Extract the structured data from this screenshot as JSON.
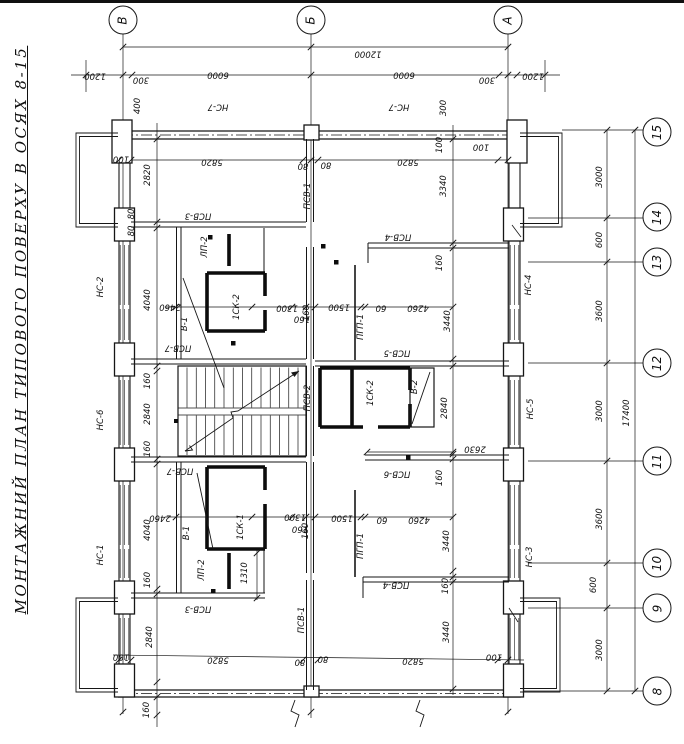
{
  "title": "МОНТАЖНИЙ ПЛАН ТИПОВОГО ПОВЕРХУ В ОСЯХ 8-15",
  "colors": {
    "ink": "#161616",
    "paper": "#ffffff"
  },
  "axes": {
    "top": [
      {
        "t": "В",
        "x": 123,
        "y": 20
      },
      {
        "t": "Б",
        "x": 311,
        "y": 20
      },
      {
        "t": "А",
        "x": 508,
        "y": 20
      }
    ],
    "right": [
      {
        "t": "15",
        "x": 657,
        "y": 132
      },
      {
        "t": "14",
        "x": 657,
        "y": 217
      },
      {
        "t": "13",
        "x": 657,
        "y": 262
      },
      {
        "t": "12",
        "x": 657,
        "y": 363
      },
      {
        "t": "11",
        "x": 657,
        "y": 461
      },
      {
        "t": "10",
        "x": 657,
        "y": 563
      },
      {
        "t": "9",
        "x": 657,
        "y": 608
      },
      {
        "t": "8",
        "x": 657,
        "y": 691
      }
    ]
  },
  "dimensions": [
    {
      "t": "12000",
      "x": 368,
      "y": 53,
      "o": "h"
    },
    {
      "t": "1200",
      "x": 95,
      "y": 75,
      "o": "h"
    },
    {
      "t": "300",
      "x": 141,
      "y": 79,
      "o": "h"
    },
    {
      "t": "6000",
      "x": 218,
      "y": 74,
      "o": "h"
    },
    {
      "t": "6000",
      "x": 404,
      "y": 74,
      "o": "h"
    },
    {
      "t": "300",
      "x": 487,
      "y": 79,
      "o": "h"
    },
    {
      "t": "1200",
      "x": 533,
      "y": 75,
      "o": "h"
    },
    {
      "t": "400",
      "x": 138,
      "y": 106,
      "o": "v"
    },
    {
      "t": "300",
      "x": 444,
      "y": 108,
      "o": "v"
    },
    {
      "t": "100",
      "x": 440,
      "y": 145,
      "o": "v"
    },
    {
      "t": "100",
      "x": 121,
      "y": 158,
      "o": "h"
    },
    {
      "t": "5820",
      "x": 212,
      "y": 161,
      "o": "h"
    },
    {
      "t": "80",
      "x": 303,
      "y": 165,
      "o": "h"
    },
    {
      "t": "80",
      "x": 326,
      "y": 164,
      "o": "h"
    },
    {
      "t": "5820",
      "x": 408,
      "y": 161,
      "o": "h"
    },
    {
      "t": "100",
      "x": 481,
      "y": 146,
      "o": "h"
    },
    {
      "t": "2820",
      "x": 148,
      "y": 175,
      "o": "v"
    },
    {
      "t": "3340",
      "x": 444,
      "y": 186,
      "o": "v"
    },
    {
      "t": "80",
      "x": 132,
      "y": 214,
      "o": "v"
    },
    {
      "t": "80",
      "x": 132,
      "y": 231,
      "o": "v"
    },
    {
      "t": "4040",
      "x": 148,
      "y": 300,
      "o": "v"
    },
    {
      "t": "160",
      "x": 148,
      "y": 381,
      "o": "v"
    },
    {
      "t": "2840",
      "x": 148,
      "y": 414,
      "o": "v"
    },
    {
      "t": "160",
      "x": 148,
      "y": 449,
      "o": "v"
    },
    {
      "t": "4040",
      "x": 148,
      "y": 530,
      "o": "v"
    },
    {
      "t": "160",
      "x": 148,
      "y": 580,
      "o": "v"
    },
    {
      "t": "2840",
      "x": 150,
      "y": 637,
      "o": "v"
    },
    {
      "t": "100",
      "x": 121,
      "y": 656,
      "o": "h"
    },
    {
      "t": "160",
      "x": 147,
      "y": 710,
      "o": "v"
    },
    {
      "t": "160",
      "x": 440,
      "y": 263,
      "o": "v"
    },
    {
      "t": "3440",
      "x": 448,
      "y": 321,
      "o": "v"
    },
    {
      "t": "2840",
      "x": 445,
      "y": 408,
      "o": "v"
    },
    {
      "t": "2630",
      "x": 475,
      "y": 448,
      "o": "h"
    },
    {
      "t": "160",
      "x": 440,
      "y": 478,
      "o": "v"
    },
    {
      "t": "3440",
      "x": 447,
      "y": 541,
      "o": "v"
    },
    {
      "t": "160",
      "x": 446,
      "y": 586,
      "o": "v"
    },
    {
      "t": "3440",
      "x": 447,
      "y": 632,
      "o": "v"
    },
    {
      "t": "2460",
      "x": 170,
      "y": 306,
      "o": "h"
    },
    {
      "t": "1300",
      "x": 287,
      "y": 307,
      "o": "h"
    },
    {
      "t": "160",
      "x": 302,
      "y": 318,
      "o": "h"
    },
    {
      "t": "1500",
      "x": 339,
      "y": 306,
      "o": "h"
    },
    {
      "t": "60",
      "x": 381,
      "y": 307,
      "o": "h"
    },
    {
      "t": "4260",
      "x": 418,
      "y": 307,
      "o": "h"
    },
    {
      "t": "160",
      "x": 307,
      "y": 313,
      "o": "v"
    },
    {
      "t": "2460",
      "x": 160,
      "y": 517,
      "o": "h"
    },
    {
      "t": "1300",
      "x": 295,
      "y": 516,
      "o": "h"
    },
    {
      "t": "160",
      "x": 300,
      "y": 528,
      "o": "h"
    },
    {
      "t": "1500",
      "x": 342,
      "y": 517,
      "o": "h"
    },
    {
      "t": "60",
      "x": 382,
      "y": 519,
      "o": "h"
    },
    {
      "t": "4260",
      "x": 419,
      "y": 519,
      "o": "h"
    },
    {
      "t": "160",
      "x": 306,
      "y": 531,
      "o": "v"
    },
    {
      "t": "1310",
      "x": 245,
      "y": 573,
      "o": "v"
    },
    {
      "t": "5820",
      "x": 218,
      "y": 659,
      "o": "h"
    },
    {
      "t": "80",
      "x": 300,
      "y": 661,
      "o": "h"
    },
    {
      "t": "80",
      "x": 323,
      "y": 658,
      "o": "h"
    },
    {
      "t": "5820",
      "x": 413,
      "y": 660,
      "o": "h"
    },
    {
      "t": "100",
      "x": 494,
      "y": 656,
      "o": "h"
    },
    {
      "t": "3000",
      "x": 600,
      "y": 177,
      "o": "v"
    },
    {
      "t": "600",
      "x": 600,
      "y": 240,
      "o": "v"
    },
    {
      "t": "3600",
      "x": 600,
      "y": 311,
      "o": "v"
    },
    {
      "t": "3000",
      "x": 600,
      "y": 411,
      "o": "v"
    },
    {
      "t": "3600",
      "x": 600,
      "y": 519,
      "o": "v"
    },
    {
      "t": "600",
      "x": 594,
      "y": 585,
      "o": "v"
    },
    {
      "t": "3000",
      "x": 600,
      "y": 650,
      "o": "v"
    },
    {
      "t": "17400",
      "x": 627,
      "y": 413,
      "o": "v"
    }
  ],
  "panel_labels": [
    {
      "t": "НС-7",
      "x": 218,
      "y": 106,
      "o": "h"
    },
    {
      "t": "НС-7",
      "x": 399,
      "y": 106,
      "o": "h"
    },
    {
      "t": "ПСВ-1",
      "x": 308,
      "y": 196,
      "o": "v"
    },
    {
      "t": "ПСВ-3",
      "x": 198,
      "y": 215,
      "o": "h"
    },
    {
      "t": "ПСВ-4",
      "x": 398,
      "y": 236,
      "o": "h"
    },
    {
      "t": "НС-2",
      "x": 101,
      "y": 287,
      "o": "v"
    },
    {
      "t": "НС-6",
      "x": 101,
      "y": 420,
      "o": "v"
    },
    {
      "t": "НС-1",
      "x": 101,
      "y": 555,
      "o": "v"
    },
    {
      "t": "НС-4",
      "x": 529,
      "y": 285,
      "o": "v"
    },
    {
      "t": "НС-5",
      "x": 531,
      "y": 409,
      "o": "v"
    },
    {
      "t": "НС-3",
      "x": 530,
      "y": 557,
      "o": "v"
    },
    {
      "t": "ЛП-2",
      "x": 205,
      "y": 247,
      "o": "v"
    },
    {
      "t": "В-1",
      "x": 185,
      "y": 324,
      "o": "v"
    },
    {
      "t": "1СК-2",
      "x": 237,
      "y": 307,
      "o": "v"
    },
    {
      "t": "ПСВ-7",
      "x": 178,
      "y": 347,
      "o": "h"
    },
    {
      "t": "ПСВ-2",
      "x": 308,
      "y": 398,
      "o": "v"
    },
    {
      "t": "ПГП-1",
      "x": 361,
      "y": 327,
      "o": "v"
    },
    {
      "t": "ПСВ-5",
      "x": 397,
      "y": 352,
      "o": "h"
    },
    {
      "t": "1СК-2",
      "x": 371,
      "y": 393,
      "o": "v"
    },
    {
      "t": "В-2",
      "x": 415,
      "y": 387,
      "o": "v"
    },
    {
      "t": "ПСВ-6",
      "x": 397,
      "y": 473,
      "o": "h"
    },
    {
      "t": "ПСВ-7",
      "x": 180,
      "y": 470,
      "o": "h"
    },
    {
      "t": "В-1",
      "x": 187,
      "y": 533,
      "o": "v"
    },
    {
      "t": "1СК-1",
      "x": 241,
      "y": 527,
      "o": "v"
    },
    {
      "t": "ЛП-2",
      "x": 202,
      "y": 570,
      "o": "v"
    },
    {
      "t": "ПГП-1",
      "x": 361,
      "y": 546,
      "o": "v"
    },
    {
      "t": "ПСВ-3",
      "x": 198,
      "y": 608,
      "o": "h"
    },
    {
      "t": "ПСВ-4",
      "x": 396,
      "y": 584,
      "o": "h"
    },
    {
      "t": "ПСВ-1",
      "x": 302,
      "y": 620,
      "o": "v"
    }
  ]
}
